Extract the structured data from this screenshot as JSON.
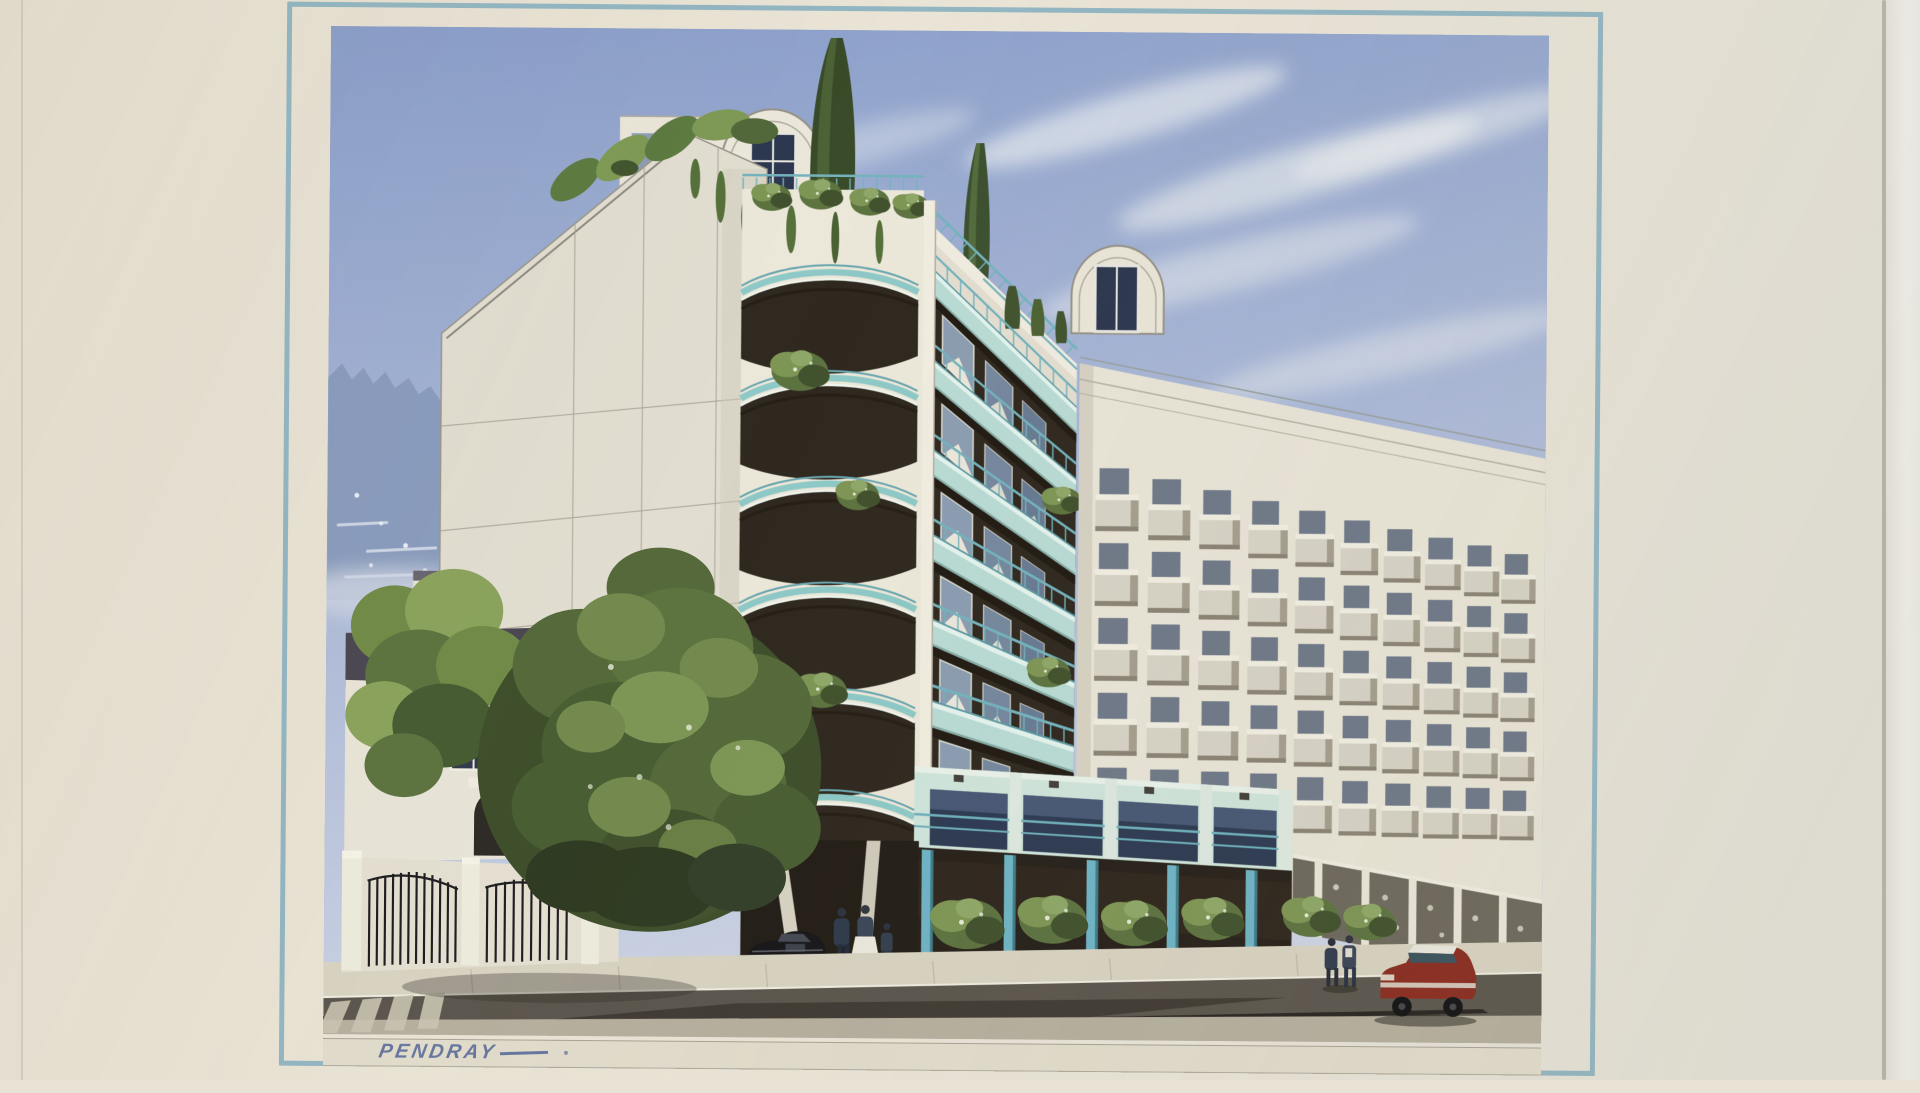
{
  "artwork": {
    "signature": "PENDRAY",
    "description": "Watercolor architectural rendering of a modern apartment building with curved teal balconies, rooftop gardens, a blank gable wall, neighboring balconied building, and a street scene with pedestrians, a black car and a red car, matted in cream with a pale blue border line"
  },
  "palette": {
    "mat_cream": "#e9e3d5",
    "border_line_blue": "#93b6c2",
    "sky_top": "#8a9ec9",
    "sky_mid": "#aab8d7",
    "sky_horizon": "#ccd3e3",
    "cloud_white": "#f4f5f3",
    "building_cream": "#ece8da",
    "building_shadow": "#d9d4c6",
    "balcony_teal": "#b9dbd4",
    "railing_teal": "#74b3bd",
    "mint_facade": "#cfe4da",
    "recess_dark_brown": "#302920",
    "window_glass_blue": "#42516c",
    "foliage_dark": "#42522e",
    "foliage_mid": "#5d7340",
    "foliage_light": "#7e9655",
    "distant_hill_blue": "#8a9cbd",
    "road_asphalt": "#5c574e",
    "sidewalk": "#d8d2c1",
    "red_car": "#8b2d21",
    "black_car": "#19181b",
    "signature_ink": "#68779e"
  }
}
